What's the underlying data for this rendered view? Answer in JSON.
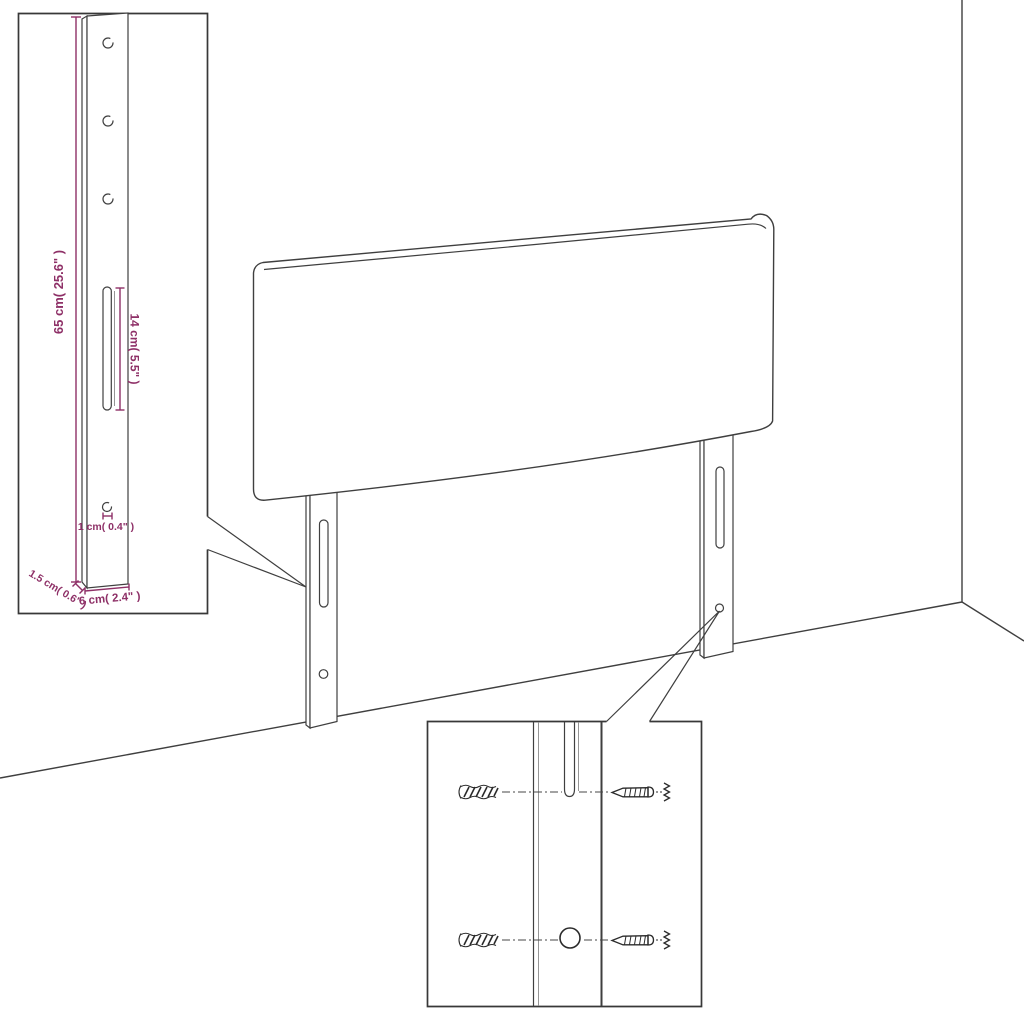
{
  "colors": {
    "dimension_accent": "#8E3067",
    "line": "#3F3F3F",
    "background": "#FFFFFF"
  },
  "insets": {
    "bracket_detail": {
      "dimensions": {
        "height": "65 cm( 25.6\" )",
        "slot_length": "14 cm( 5.5\" )",
        "hole": "1 cm( 0.4\" )",
        "thickness": "1.5 cm( 0.6\" )",
        "width": "6 cm( 2.4\" )"
      }
    },
    "mounting_detail": {
      "parts": [
        "wall-anchor-icon",
        "screw-icon"
      ]
    }
  }
}
